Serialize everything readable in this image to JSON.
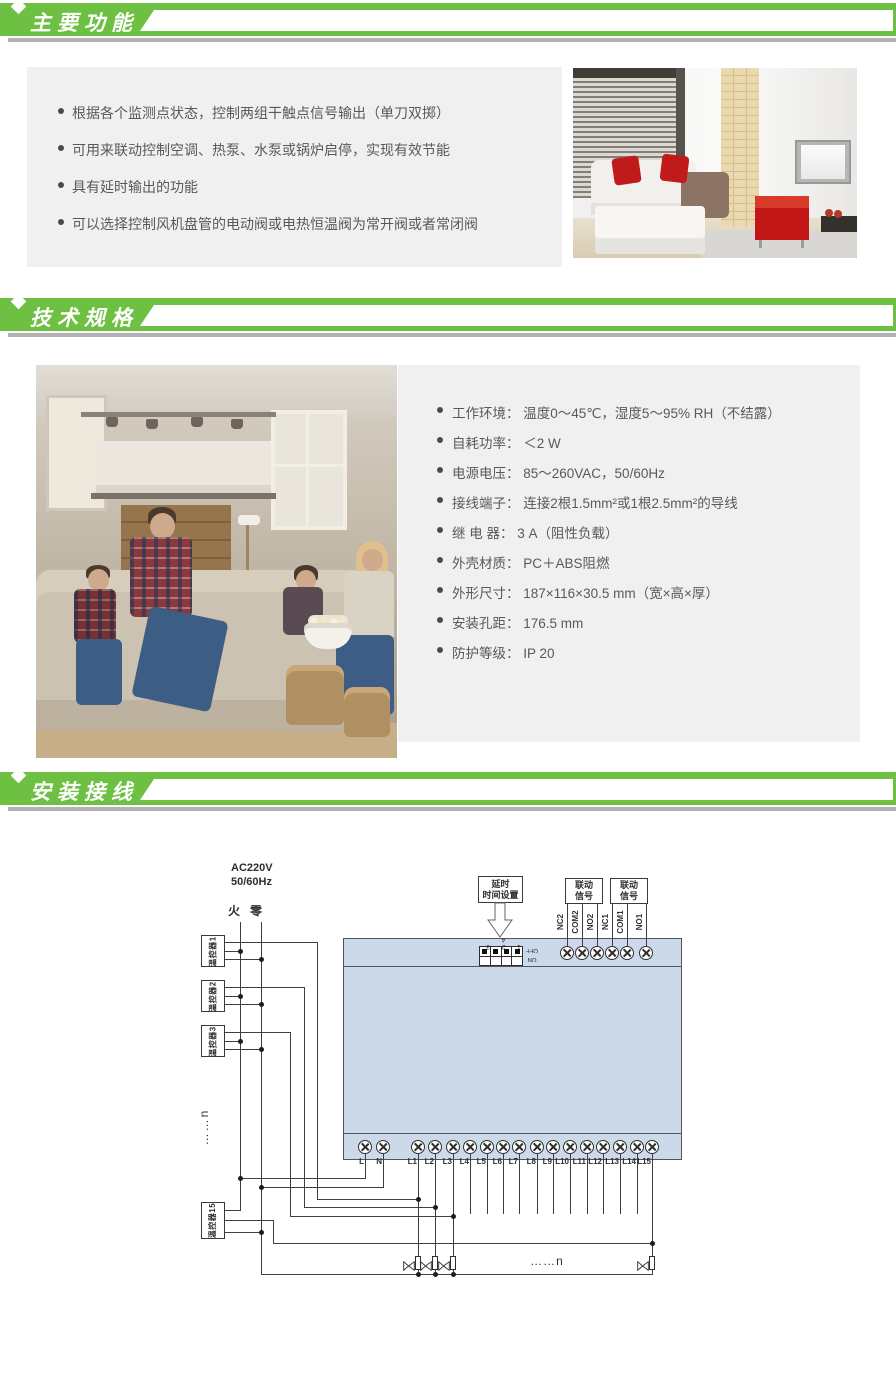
{
  "theme": {
    "green": "#6ec043",
    "panel_gray": "#f0f0f0",
    "text_gray": "#595959",
    "shadow_gray": "#b2b2b2",
    "device_fill": "#ccd9e9",
    "line_color": "#3f3f3f",
    "accent_red": "#c01616"
  },
  "sections": [
    {
      "title": "主要功能"
    },
    {
      "title": "技术规格"
    },
    {
      "title": "安装接线"
    }
  ],
  "features": {
    "bullets": [
      "根据各个监测点状态，控制两组干触点信号输出（单刀双掷）",
      "可用来联动控制空调、热泵、水泵或锅炉启停，实现有效节能",
      "具有延时输出的功能",
      "可以选择控制风机盘管的电动阀或电热恒温阀为常开阀或者常闭阀"
    ]
  },
  "specs": {
    "items": [
      {
        "label": "工作环境：",
        "value": "温度0～45℃，湿度5～95% RH（不结露）"
      },
      {
        "label": "自耗功率：",
        "value": "＜2 W"
      },
      {
        "label": "电源电压：",
        "value": "85～260VAC，50/60Hz"
      },
      {
        "label": "接线端子：",
        "value": "连接2根1.5mm²或1根2.5mm²的导线"
      },
      {
        "label": "继 电 器：",
        "value": "3 A（阻性负载）"
      },
      {
        "label": "外壳材质：",
        "value": "PC＋ABS阻燃"
      },
      {
        "label": "外形尺寸：",
        "value": "187×116×30.5 mm（宽×高×厚）"
      },
      {
        "label": "安装孔距：",
        "value": "176.5 mm"
      },
      {
        "label": "防护等级：",
        "value": "IP 20"
      }
    ]
  },
  "diagram": {
    "power_line1": "AC220V",
    "power_line2": "50/60Hz",
    "live": "火",
    "neutral": "零",
    "thermostats": [
      "温控器1",
      "温控器2",
      "温控器3",
      "温控器15"
    ],
    "vertical_ellipsis": "……n",
    "horizontal_ellipsis": "……n",
    "delay_box_line1": "延时",
    "delay_box_line2": "时间设置",
    "linkage_line1": "联动",
    "linkage_line2": "信号",
    "dip_numbers": "1 2 3 4",
    "dip_off": "OFF",
    "dip_on": "ON",
    "output_terminals": [
      "NC2",
      "COM2",
      "NO2",
      "NC1",
      "COM1",
      "NO1"
    ],
    "input_terminals": [
      "L",
      "N",
      "L1",
      "L2",
      "L3",
      "L4",
      "L5",
      "L6",
      "L7",
      "L8",
      "L9",
      "L10",
      "L11",
      "L12",
      "L13",
      "L14",
      "L15"
    ]
  }
}
